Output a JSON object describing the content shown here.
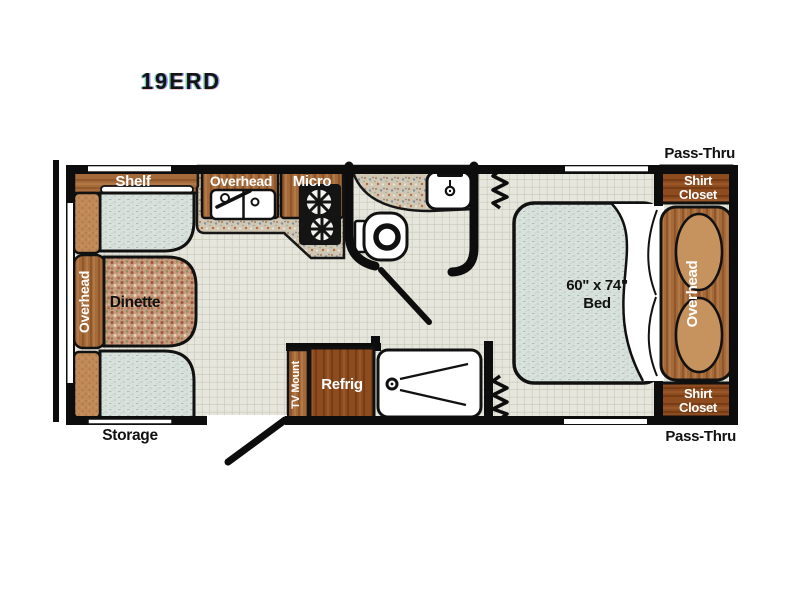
{
  "model_badge": "19ERD",
  "labels": {
    "shelf": "Shelf",
    "overhead_rear": "Overhead",
    "dinette": "Dinette",
    "storage": "Storage",
    "overhead_kitchen": "Overhead",
    "micro": "Micro",
    "tv_mount": "TV Mount",
    "refrig": "Refrig",
    "bed_size": "60\" x 74\"",
    "bed": "Bed",
    "overhead_bedroom": "Overhead",
    "shirt_closet_top": {
      "line1": "Shirt",
      "line2": "Closet"
    },
    "shirt_closet_bottom": {
      "line1": "Shirt",
      "line2": "Closet"
    },
    "pass_thru_top": "Pass-Thru",
    "pass_thru_bottom": "Pass-Thru"
  },
  "colors": {
    "wall": "#111111",
    "floor_tile": "#e6e6dc",
    "tile_grout": "#c7c9ba",
    "wood": "#a56a3a",
    "dark_wood": "#8c4c20",
    "tan_cushion": "#c6925e",
    "counter_speckle_base": "#cfc6b4",
    "mattress": "#d9e1dc",
    "dinette_fabric": "#c59a80"
  }
}
